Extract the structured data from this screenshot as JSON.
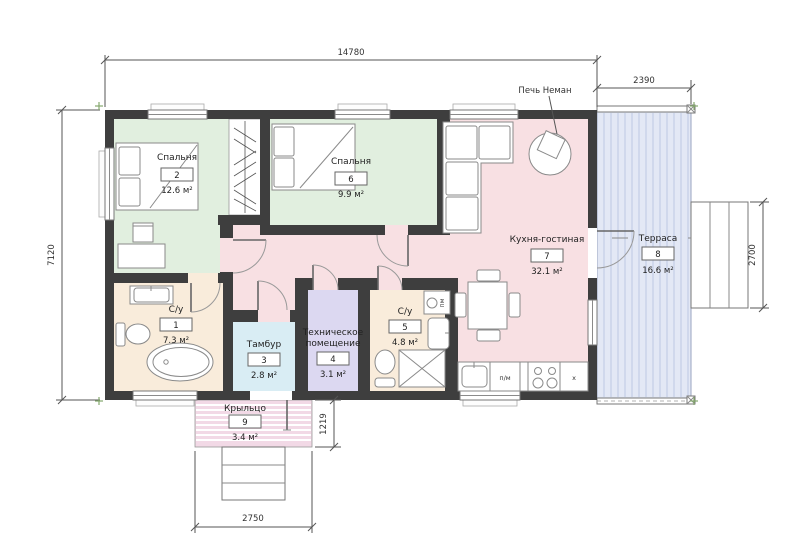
{
  "dimensions": {
    "overall_width": "14780",
    "terrace_width": "2390",
    "overall_depth": "7120",
    "terrace_steps_depth": "2700",
    "porch_depth": "1219",
    "porch_width": "2750"
  },
  "rooms": [
    {
      "name": "С/у",
      "number": "1",
      "area": "7.3 м²"
    },
    {
      "name": "Спальня",
      "number": "2",
      "area": "12.6 м²"
    },
    {
      "name": "Тамбур",
      "number": "3",
      "area": "2.8 м²"
    },
    {
      "name": "Техническое помещение",
      "name_l1": "Техническое",
      "name_l2": "помещение",
      "number": "4",
      "area": "3.1 м²"
    },
    {
      "name": "С/у",
      "number": "5",
      "area": "4.8 м²"
    },
    {
      "name": "Спальня",
      "number": "6",
      "area": "9.9 м²"
    },
    {
      "name": "Кухня-гостиная",
      "number": "7",
      "area": "32.1 м²"
    },
    {
      "name": "Терраса",
      "number": "8",
      "area": "16.6 м²"
    },
    {
      "name": "Крыльцо",
      "number": "9",
      "area": "3.4 м²"
    }
  ],
  "annotations": {
    "stove": "Печь Неман",
    "dishwasher": "п/м",
    "washer": "пм",
    "fridge": "х"
  },
  "colors": {
    "wall": "#3e3e3e",
    "hall": "#f8e0e3",
    "bedroom": "#e1efdf",
    "bathroom": "#f9ecdb",
    "tambour": "#d9edf4",
    "tech": "#dcd8f1",
    "terrace": "#e3e8f5",
    "porch": "#f2d9e6"
  }
}
